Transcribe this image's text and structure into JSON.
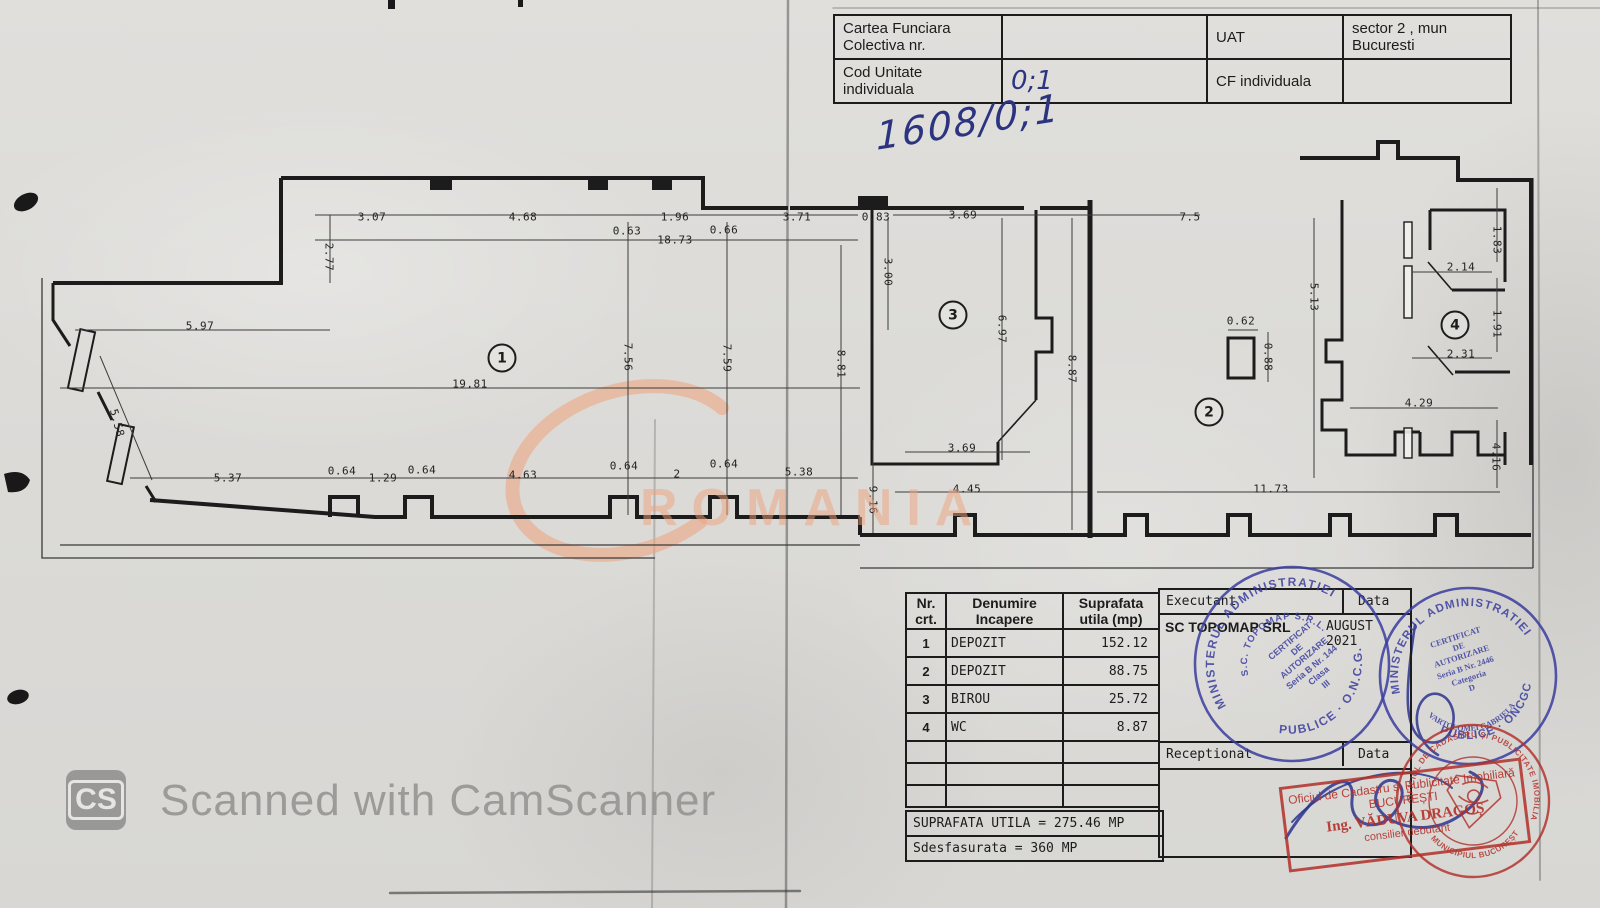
{
  "header_table": {
    "rows": [
      {
        "label_left": "Cartea Funciara Colectiva nr.",
        "value_left": "",
        "label_right": "UAT",
        "value_right": "sector 2 , mun Bucuresti"
      },
      {
        "label_left": "Cod Unitate individuala",
        "value_left": "0;1",
        "label_right": "CF individuala",
        "value_right": ""
      }
    ]
  },
  "handwritten_ref": "1608/0;1",
  "plan": {
    "rooms": [
      {
        "n": "1",
        "x": 502,
        "y": 358
      },
      {
        "n": "2",
        "x": 1209,
        "y": 412
      },
      {
        "n": "3",
        "x": 953,
        "y": 315
      },
      {
        "n": "4",
        "x": 1455,
        "y": 325
      }
    ],
    "dimensions": [
      {
        "t": "3.07",
        "x": 372,
        "y": 217,
        "r": 0
      },
      {
        "t": "4.68",
        "x": 523,
        "y": 217,
        "r": 0
      },
      {
        "t": "1.96",
        "x": 675,
        "y": 217,
        "r": 0
      },
      {
        "t": "3.71",
        "x": 797,
        "y": 217,
        "r": 0
      },
      {
        "t": "0.83",
        "x": 876,
        "y": 217,
        "r": 0
      },
      {
        "t": "3.69",
        "x": 963,
        "y": 215,
        "r": 0
      },
      {
        "t": "7.5",
        "x": 1190,
        "y": 217,
        "r": 0
      },
      {
        "t": "0.63",
        "x": 627,
        "y": 231,
        "r": 0
      },
      {
        "t": "0.66",
        "x": 724,
        "y": 230,
        "r": 0
      },
      {
        "t": "18.73",
        "x": 675,
        "y": 240,
        "r": 0
      },
      {
        "t": "2.77",
        "x": 329,
        "y": 257,
        "r": 90
      },
      {
        "t": "3.00",
        "x": 888,
        "y": 272,
        "r": 90
      },
      {
        "t": "5.97",
        "x": 200,
        "y": 326,
        "r": 0
      },
      {
        "t": "7.56",
        "x": 628,
        "y": 357,
        "r": 90
      },
      {
        "t": "7.59",
        "x": 727,
        "y": 358,
        "r": 90
      },
      {
        "t": "8.81",
        "x": 841,
        "y": 364,
        "r": 90
      },
      {
        "t": "6.97",
        "x": 1002,
        "y": 329,
        "r": 90
      },
      {
        "t": "8.87",
        "x": 1072,
        "y": 369,
        "r": 90
      },
      {
        "t": "5.13",
        "x": 1314,
        "y": 297,
        "r": 90
      },
      {
        "t": "0.62",
        "x": 1241,
        "y": 321,
        "r": 0
      },
      {
        "t": "0.88",
        "x": 1268,
        "y": 357,
        "r": 90
      },
      {
        "t": "1.83",
        "x": 1497,
        "y": 240,
        "r": 90
      },
      {
        "t": "2.14",
        "x": 1461,
        "y": 267,
        "r": 0
      },
      {
        "t": "1.91",
        "x": 1497,
        "y": 324,
        "r": 90
      },
      {
        "t": "2.31",
        "x": 1461,
        "y": 354,
        "r": 0
      },
      {
        "t": "4.29",
        "x": 1419,
        "y": 403,
        "r": 0
      },
      {
        "t": "4.16",
        "x": 1496,
        "y": 457,
        "r": 90
      },
      {
        "t": "19.81",
        "x": 470,
        "y": 384,
        "r": 0
      },
      {
        "t": "5.58",
        "x": 117,
        "y": 423,
        "r": 75
      },
      {
        "t": "5.37",
        "x": 228,
        "y": 478,
        "r": 0
      },
      {
        "t": "0.64",
        "x": 342,
        "y": 471,
        "r": 0
      },
      {
        "t": "1.29",
        "x": 383,
        "y": 478,
        "r": 0
      },
      {
        "t": "0.64",
        "x": 422,
        "y": 470,
        "r": 0
      },
      {
        "t": "4.63",
        "x": 523,
        "y": 475,
        "r": 0
      },
      {
        "t": "0.64",
        "x": 624,
        "y": 466,
        "r": 0
      },
      {
        "t": "2",
        "x": 677,
        "y": 474,
        "r": 0
      },
      {
        "t": "0.64",
        "x": 724,
        "y": 464,
        "r": 0
      },
      {
        "t": "5.38",
        "x": 799,
        "y": 472,
        "r": 0
      },
      {
        "t": "3.69",
        "x": 962,
        "y": 448,
        "r": 0
      },
      {
        "t": "4.45",
        "x": 967,
        "y": 489,
        "r": 0
      },
      {
        "t": "9.16",
        "x": 873,
        "y": 500,
        "r": 90
      },
      {
        "t": "11.73",
        "x": 1271,
        "y": 489,
        "r": 0
      }
    ]
  },
  "room_table": {
    "header": {
      "col1": "Nr. crt.",
      "col2": "Denumire Incapere",
      "col3": "Suprafata utila (mp)"
    },
    "rows": [
      {
        "nr": "1",
        "name": "DEPOZIT",
        "area": "152.12"
      },
      {
        "nr": "2",
        "name": "DEPOZIT",
        "area": "88.75"
      },
      {
        "nr": "3",
        "name": "BIROU",
        "area": "25.72"
      },
      {
        "nr": "4",
        "name": "WC",
        "area": "8.87"
      }
    ],
    "total_line": "SUPRAFATA UTILA = 275.46 MP",
    "desfasurata_line": "Sdesfasurata = 360 MP"
  },
  "exec_box": {
    "executant_label": "Executant",
    "data_label": "Data",
    "executant_value": "SC TOPOMAP SRL",
    "data_value": "AUGUST 2021",
    "receptionat_label": "Receptionat",
    "receptionat_data_label": "Data"
  },
  "stamps": {
    "topomap_circle": {
      "ring_top": "MINISTERUL ADMINISTRATIEI",
      "ring_bottom": "PUBLICE · O.N.C.G.C.",
      "inner_arc": "S.C. TOPOMAP S.R.L.",
      "line1": "CERTIFICAT",
      "line2": "DE",
      "line3": "AUTORIZARE",
      "line4": "Seria B Nr. 144",
      "line5": "Clasa",
      "line6": "III"
    },
    "gabriela_circle": {
      "ring_top": "MINISTERUL ADMINISTRATIEI",
      "ring_bottom": "PUBLICE · ONCGC",
      "line1": "CERTIFICAT",
      "line2": "DE",
      "line3": "AUTORIZARE",
      "line4": "Seria B Nr. 2446",
      "line5": "Categoria",
      "line6": "D",
      "arc_name": "VARTOLOMEI GABRIELA"
    },
    "ocpi_red_box": {
      "line1": "Oficiul de Cadastru și Publicitate Imobiliară",
      "line2": "BUCUREȘTI",
      "line3": "Ing. VĂDUVA DRAGOȘ",
      "line4": "consilier debutant"
    },
    "ocpi_red_circle": {
      "ring_top": "OFICIUL DE CADASTRU ȘI PUBLICITATE IMOBILIARĂ",
      "ring_bottom": "MUNICIPIUL BUCUREȘTI"
    }
  },
  "watermarks": {
    "camscanner_badge": "CS",
    "camscanner_text": "Scanned with CamScanner",
    "romania": "ROMANIA"
  },
  "colors": {
    "ink_blue": "#2c347f",
    "stamp_blue": "#3a3e9e",
    "stamp_red": "#b2302a",
    "watermark_orange": "#eea27c",
    "plan_line": "#1c1c1c"
  }
}
